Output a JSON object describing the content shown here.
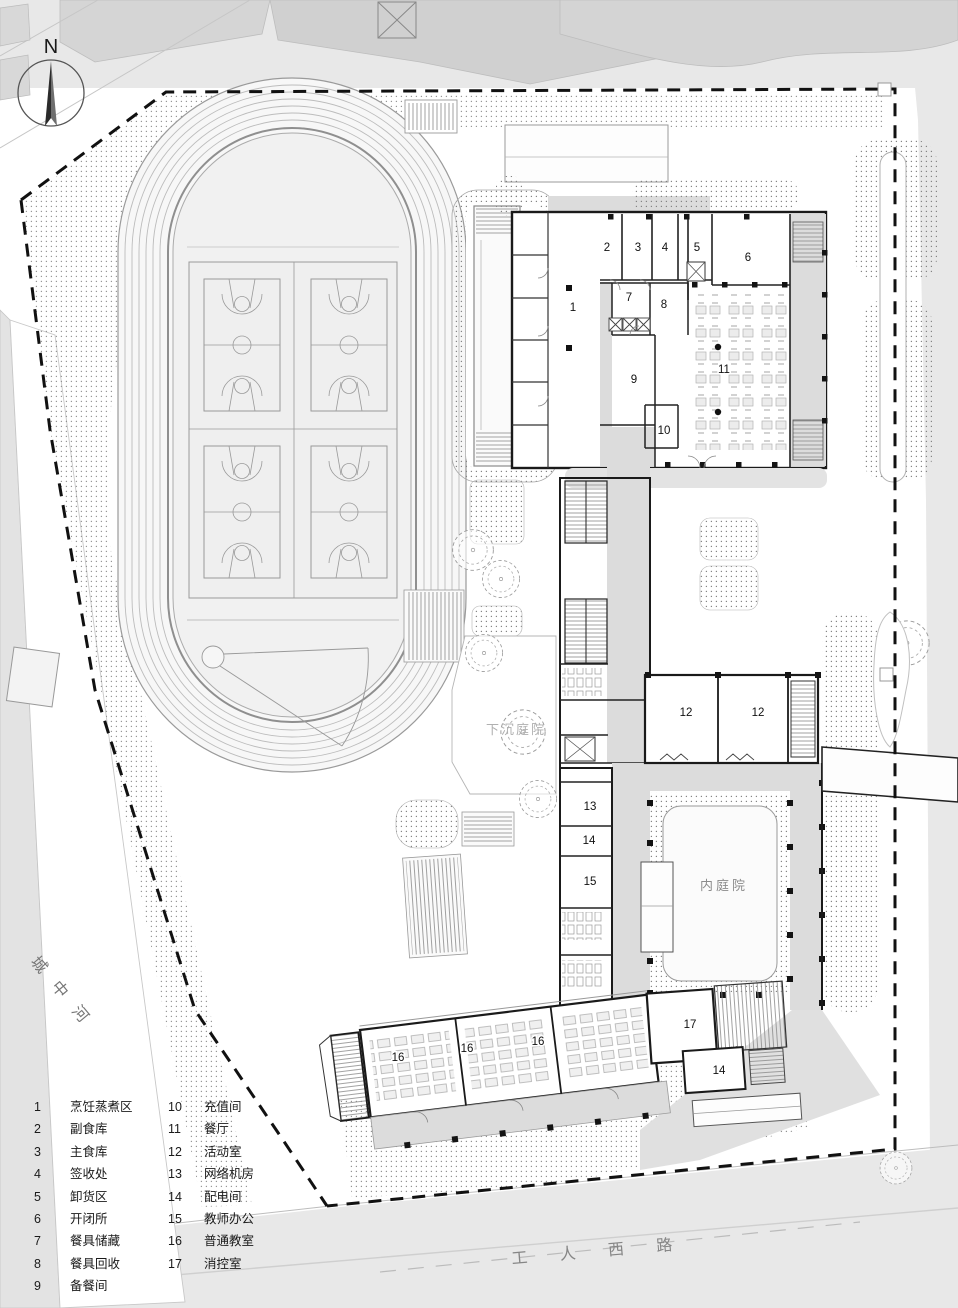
{
  "compass": {
    "label": "N"
  },
  "roads": {
    "west_river": "城中河",
    "south_road": "工 人 西 路"
  },
  "courtyards": {
    "sunken": "下沉庭院",
    "inner": "内庭院"
  },
  "rooms": {
    "r1": "1",
    "r2": "2",
    "r3": "3",
    "r4": "4",
    "r5": "5",
    "r6": "6",
    "r7": "7",
    "r8": "8",
    "r9": "9",
    "r10": "10",
    "r11": "11",
    "r12": "12",
    "r13": "13",
    "r14": "14",
    "r15": "15",
    "r16": "16",
    "r17": "17"
  },
  "legend": {
    "col1": [
      {
        "num": "1",
        "label": "烹饪蒸煮区"
      },
      {
        "num": "2",
        "label": "副食库"
      },
      {
        "num": "3",
        "label": "主食库"
      },
      {
        "num": "4",
        "label": "签收处"
      },
      {
        "num": "5",
        "label": "卸货区"
      },
      {
        "num": "6",
        "label": "开闭所"
      },
      {
        "num": "7",
        "label": "餐具储藏"
      },
      {
        "num": "8",
        "label": "餐具回收"
      },
      {
        "num": "9",
        "label": "备餐间"
      }
    ],
    "col2": [
      {
        "num": "10",
        "label": "充值间"
      },
      {
        "num": "11",
        "label": "餐厅"
      },
      {
        "num": "12",
        "label": "活动室"
      },
      {
        "num": "13",
        "label": "网络机房"
      },
      {
        "num": "14",
        "label": "配电间"
      },
      {
        "num": "15",
        "label": "教师办公"
      },
      {
        "num": "16",
        "label": "普通教室"
      },
      {
        "num": "17",
        "label": "消控室"
      }
    ]
  },
  "colors": {
    "wall": "#1a1a1a",
    "corridor": "#dcdcdc",
    "road_gray": "#e8e8e8",
    "infield": "#f1f1f1",
    "dot_hatch": "#808080",
    "boundary": "#111111"
  }
}
